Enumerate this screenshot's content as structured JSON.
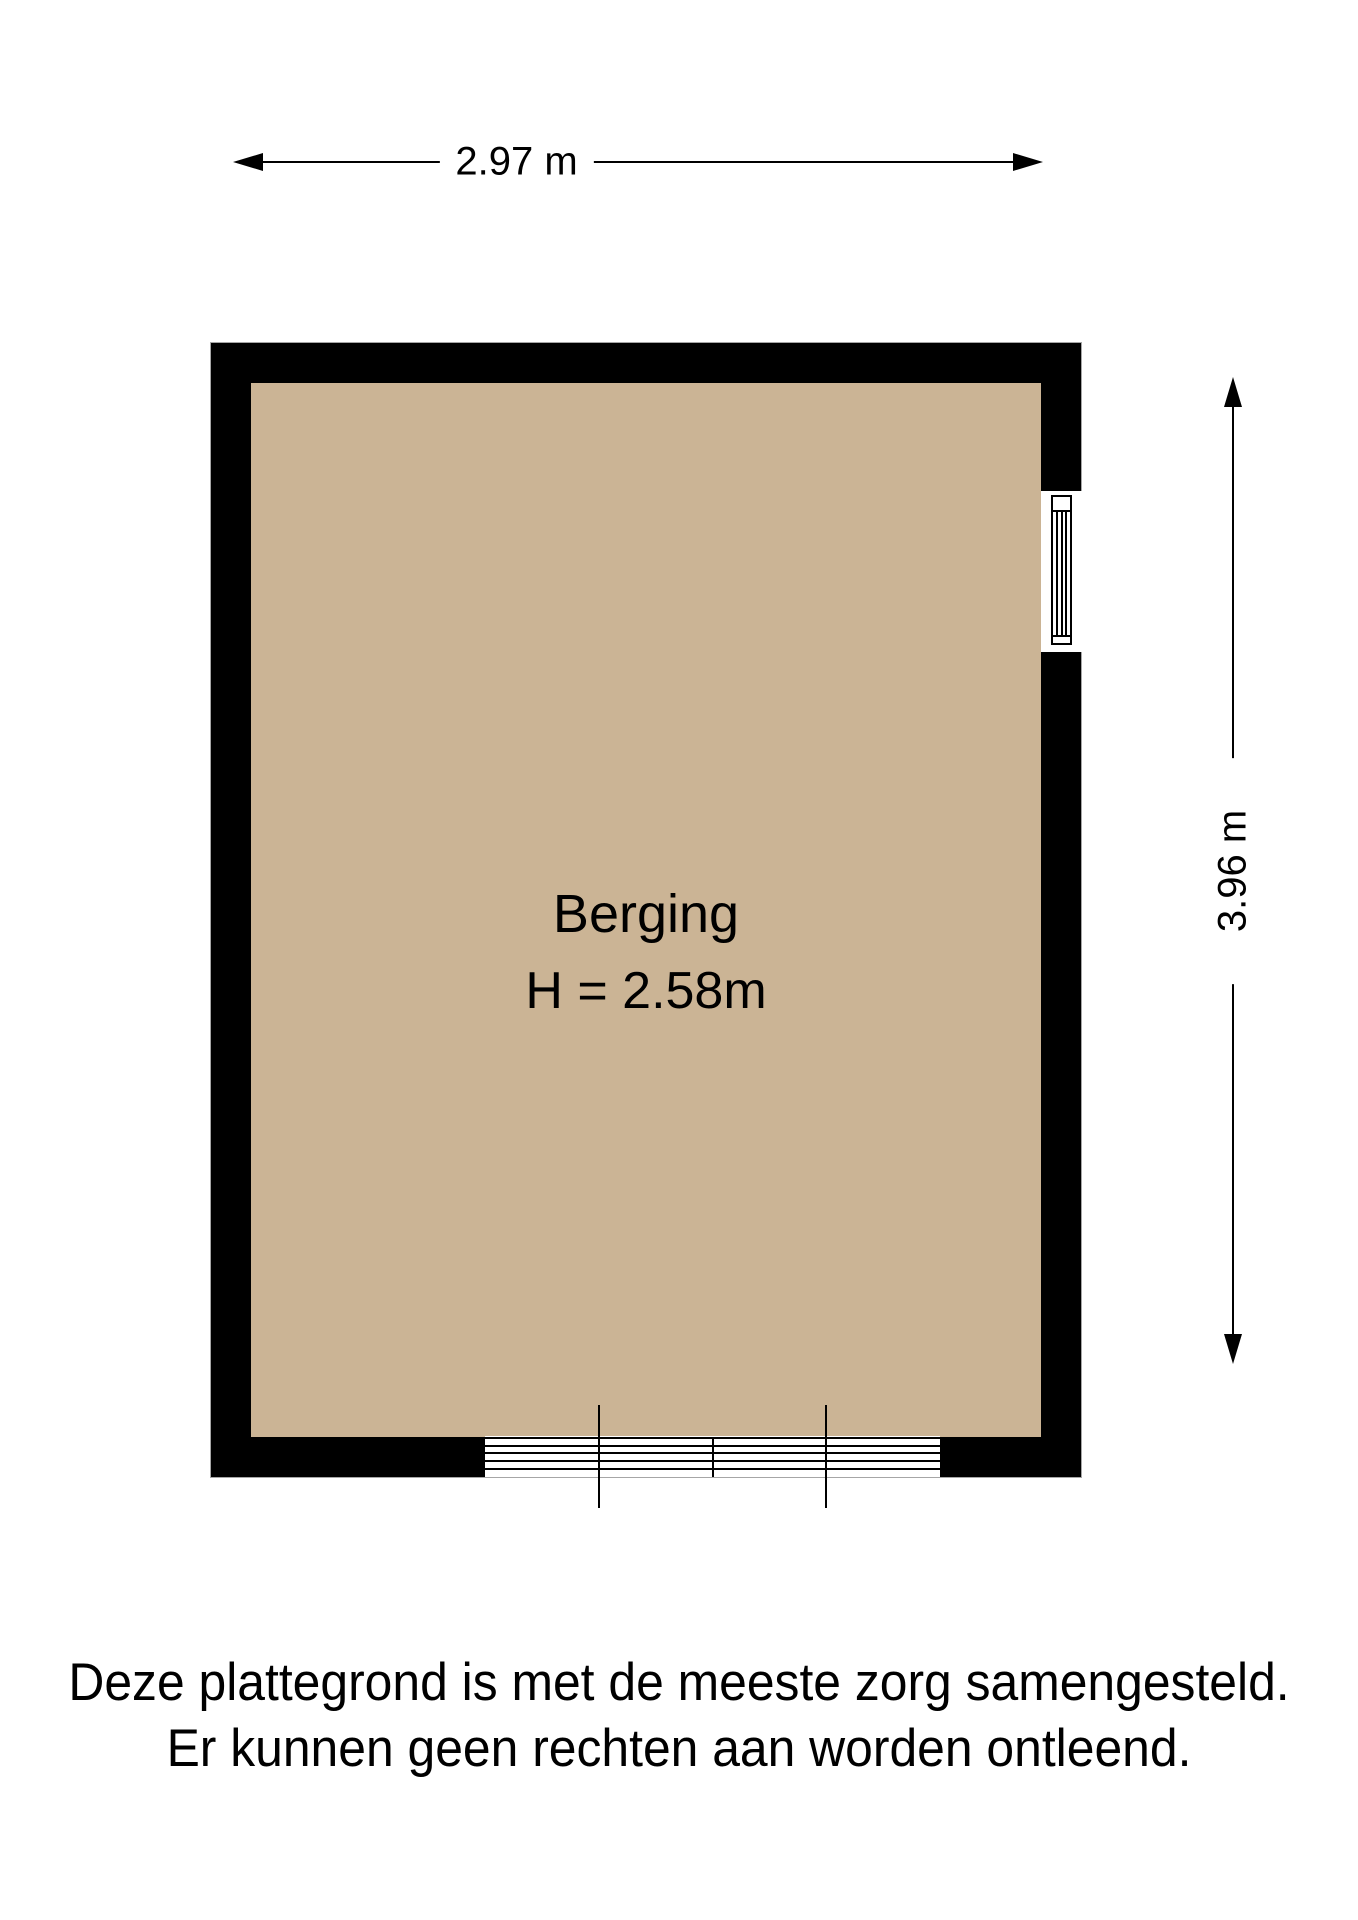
{
  "page": {
    "background_color": "#ffffff",
    "text_color": "#000000"
  },
  "floorplan": {
    "room": {
      "name": "Berging",
      "height_label": "H = 2.58m",
      "floor_color": "#cbb495",
      "wall_color": "#000000",
      "features": {
        "right_wall": "window",
        "bottom_wall": "sliding-glass-door"
      }
    },
    "dimensions": {
      "width": {
        "label": "2.97 m"
      },
      "height": {
        "label": "3.96 m"
      }
    }
  },
  "disclaimer": {
    "line1": "Deze plattegrond is met de meeste zorg samengesteld.",
    "line2": "Er kunnen geen rechten aan worden ontleend."
  }
}
